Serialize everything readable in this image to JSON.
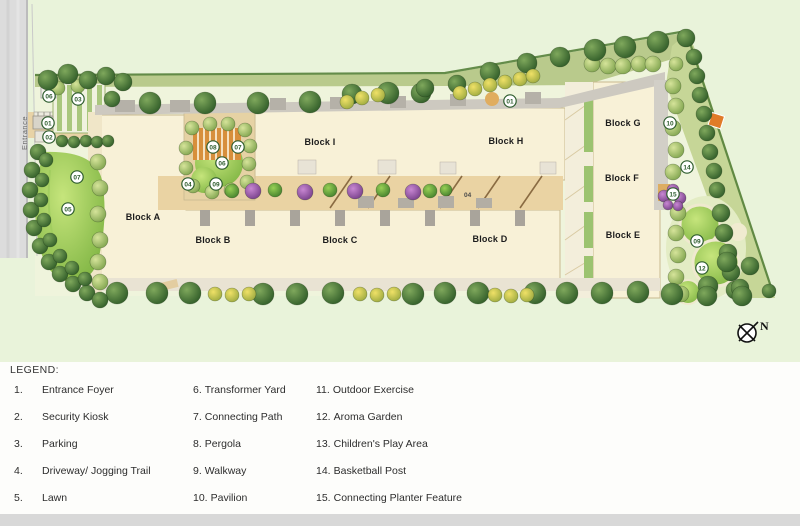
{
  "plan": {
    "entrance_label": "Entrance",
    "compass_label": "N",
    "driveway_code": "04",
    "colors": {
      "canvas_green": "#e9f3da",
      "site_interior": "#eff4dc",
      "building_cream": "#f8f1d7",
      "driveway_tan": "#ead3a3",
      "road_gray": "#dcdcdc",
      "tree_dark_green": "#2e5a27",
      "tree_light_green": "#7da24c",
      "flowering_purple": "#8a4a9a",
      "bush_yellow": "#e8d95f",
      "lawn_green": "#7ab13f",
      "marker_green": "#2e5d2e",
      "pergola_orange": "#d78f3c",
      "pavilion_orange": "#e07b28"
    },
    "blocks": [
      {
        "label": "Block A",
        "x": 143,
        "y": 220
      },
      {
        "label": "Block B",
        "x": 213,
        "y": 243
      },
      {
        "label": "Block C",
        "x": 340,
        "y": 243
      },
      {
        "label": "Block D",
        "x": 490,
        "y": 242
      },
      {
        "label": "Block E",
        "x": 623,
        "y": 238
      },
      {
        "label": "Block F",
        "x": 622,
        "y": 181
      },
      {
        "label": "Block G",
        "x": 623,
        "y": 126
      },
      {
        "label": "Block H",
        "x": 506,
        "y": 144
      },
      {
        "label": "Block I",
        "x": 320,
        "y": 145
      }
    ],
    "markers": [
      {
        "n": "06",
        "x": 49,
        "y": 96
      },
      {
        "n": "03",
        "x": 78,
        "y": 99
      },
      {
        "n": "01",
        "x": 48,
        "y": 123
      },
      {
        "n": "02",
        "x": 49,
        "y": 137
      },
      {
        "n": "07",
        "x": 77,
        "y": 177
      },
      {
        "n": "05",
        "x": 68,
        "y": 209
      },
      {
        "n": "08",
        "x": 213,
        "y": 147
      },
      {
        "n": "07",
        "x": 238,
        "y": 147
      },
      {
        "n": "06",
        "x": 222,
        "y": 163
      },
      {
        "n": "04",
        "x": 188,
        "y": 184
      },
      {
        "n": "09",
        "x": 216,
        "y": 184
      },
      {
        "n": "01",
        "x": 510,
        "y": 101
      },
      {
        "n": "10",
        "x": 670,
        "y": 123
      },
      {
        "n": "14",
        "x": 687,
        "y": 167
      },
      {
        "n": "15",
        "x": 673,
        "y": 194
      },
      {
        "n": "09",
        "x": 697,
        "y": 241
      },
      {
        "n": "12",
        "x": 702,
        "y": 268
      }
    ],
    "trees": {
      "dark": [
        [
          48,
          80,
          10
        ],
        [
          68,
          74,
          10
        ],
        [
          88,
          80,
          9
        ],
        [
          106,
          76,
          9
        ],
        [
          123,
          82,
          9
        ],
        [
          112,
          99,
          8
        ],
        [
          150,
          103,
          11
        ],
        [
          205,
          103,
          11
        ],
        [
          258,
          103,
          11
        ],
        [
          310,
          102,
          11
        ],
        [
          352,
          94,
          10
        ],
        [
          388,
          93,
          11
        ],
        [
          421,
          93,
          10
        ],
        [
          425,
          88,
          9
        ],
        [
          457,
          84,
          9
        ],
        [
          490,
          72,
          10
        ],
        [
          527,
          63,
          10
        ],
        [
          560,
          57,
          10
        ],
        [
          595,
          50,
          11
        ],
        [
          625,
          47,
          11
        ],
        [
          658,
          42,
          11
        ],
        [
          686,
          38,
          9
        ],
        [
          694,
          57,
          8
        ],
        [
          697,
          76,
          8
        ],
        [
          700,
          95,
          8
        ],
        [
          704,
          114,
          8
        ],
        [
          707,
          133,
          8
        ],
        [
          710,
          152,
          8
        ],
        [
          714,
          171,
          8
        ],
        [
          717,
          190,
          8
        ],
        [
          721,
          213,
          9
        ],
        [
          724,
          233,
          9
        ],
        [
          728,
          253,
          9
        ],
        [
          731,
          272,
          9
        ],
        [
          735,
          290,
          9
        ],
        [
          727,
          262,
          10
        ],
        [
          750,
          266,
          9
        ],
        [
          708,
          286,
          10
        ],
        [
          740,
          288,
          9
        ],
        [
          117,
          293,
          11
        ],
        [
          157,
          293,
          11
        ],
        [
          190,
          293,
          11
        ],
        [
          263,
          294,
          11
        ],
        [
          297,
          294,
          11
        ],
        [
          333,
          293,
          11
        ],
        [
          413,
          294,
          11
        ],
        [
          445,
          293,
          11
        ],
        [
          478,
          293,
          11
        ],
        [
          535,
          293,
          11
        ],
        [
          567,
          293,
          11
        ],
        [
          602,
          293,
          11
        ],
        [
          638,
          292,
          11
        ],
        [
          672,
          294,
          11
        ],
        [
          707,
          296,
          10
        ],
        [
          742,
          296,
          10
        ],
        [
          769,
          291,
          7
        ],
        [
          38,
          152,
          8
        ],
        [
          32,
          170,
          8
        ],
        [
          30,
          190,
          8
        ],
        [
          31,
          210,
          8
        ],
        [
          34,
          228,
          8
        ],
        [
          40,
          246,
          8
        ],
        [
          49,
          262,
          8
        ],
        [
          60,
          274,
          8
        ],
        [
          73,
          284,
          8
        ],
        [
          87,
          293,
          8
        ],
        [
          100,
          300,
          8
        ],
        [
          46,
          160,
          7
        ],
        [
          42,
          180,
          7
        ],
        [
          41,
          200,
          7
        ],
        [
          44,
          220,
          7
        ],
        [
          50,
          240,
          7
        ],
        [
          60,
          256,
          7
        ],
        [
          72,
          268,
          7
        ],
        [
          85,
          279,
          7
        ]
      ],
      "light": [
        [
          58,
          88,
          7
        ],
        [
          78,
          86,
          7
        ],
        [
          592,
          64,
          8
        ],
        [
          608,
          66,
          8
        ],
        [
          623,
          66,
          8
        ],
        [
          639,
          64,
          8
        ],
        [
          653,
          64,
          8
        ],
        [
          676,
          64,
          7
        ],
        [
          673,
          86,
          8
        ],
        [
          676,
          106,
          8
        ],
        [
          673,
          128,
          8
        ],
        [
          676,
          150,
          8
        ],
        [
          673,
          172,
          8
        ],
        [
          678,
          213,
          8
        ],
        [
          676,
          233,
          8
        ],
        [
          678,
          255,
          8
        ],
        [
          676,
          277,
          8
        ],
        [
          681,
          294,
          8
        ],
        [
          98,
          162,
          8
        ],
        [
          100,
          188,
          8
        ],
        [
          98,
          214,
          8
        ],
        [
          100,
          240,
          8
        ],
        [
          98,
          262,
          8
        ],
        [
          100,
          282,
          8
        ],
        [
          192,
          128,
          7
        ],
        [
          210,
          124,
          7
        ],
        [
          228,
          124,
          7
        ],
        [
          245,
          130,
          7
        ],
        [
          250,
          146,
          7
        ],
        [
          249,
          164,
          7
        ],
        [
          247,
          182,
          7
        ],
        [
          231,
          190,
          7
        ],
        [
          212,
          192,
          7
        ],
        [
          193,
          186,
          7
        ],
        [
          186,
          168,
          7
        ],
        [
          186,
          148,
          7
        ]
      ],
      "yellow": [
        [
          347,
          102,
          7
        ],
        [
          362,
          98,
          7
        ],
        [
          378,
          95,
          7
        ],
        [
          460,
          93,
          7
        ],
        [
          475,
          89,
          7
        ],
        [
          490,
          85,
          7
        ],
        [
          505,
          82,
          7
        ],
        [
          520,
          79,
          7
        ],
        [
          533,
          76,
          7
        ],
        [
          215,
          294,
          7
        ],
        [
          232,
          295,
          7
        ],
        [
          249,
          294,
          7
        ],
        [
          360,
          294,
          7
        ],
        [
          377,
          295,
          7
        ],
        [
          394,
          294,
          7
        ],
        [
          495,
          295,
          7
        ],
        [
          511,
          296,
          7
        ],
        [
          527,
          295,
          7
        ]
      ],
      "shrub": [
        [
          232,
          191,
          7
        ],
        [
          275,
          190,
          7
        ],
        [
          330,
          190,
          7
        ],
        [
          383,
          190,
          7
        ],
        [
          430,
          191,
          7
        ],
        [
          446,
          190,
          6
        ]
      ],
      "hedge": [
        [
          62,
          141,
          6
        ],
        [
          74,
          142,
          6
        ],
        [
          86,
          141,
          6
        ],
        [
          97,
          142,
          6
        ],
        [
          108,
          141,
          6
        ]
      ],
      "purple": [
        [
          253,
          191,
          8
        ],
        [
          305,
          192,
          8
        ],
        [
          355,
          191,
          8
        ],
        [
          413,
          192,
          8
        ],
        [
          664,
          196,
          6
        ],
        [
          673,
          190,
          6
        ],
        [
          680,
          198,
          6
        ],
        [
          668,
          205,
          5
        ],
        [
          678,
          206,
          5
        ]
      ]
    }
  },
  "legend": {
    "title": "LEGEND:",
    "columns": [
      {
        "items": [
          {
            "num": "1.",
            "label": "Entrance Foyer"
          },
          {
            "num": "2.",
            "label": "Security Kiosk"
          },
          {
            "num": "3.",
            "label": "Parking"
          },
          {
            "num": "4.",
            "label": "Driveway/ Jogging Trail"
          },
          {
            "num": "5.",
            "label": "Lawn"
          }
        ]
      },
      {
        "items": [
          {
            "num": "6.",
            "label": "Transformer Yard"
          },
          {
            "num": "7.",
            "label": "Connecting Path"
          },
          {
            "num": "8.",
            "label": "Pergola"
          },
          {
            "num": "9.",
            "label": "Walkway"
          },
          {
            "num": "10.",
            "label": "Pavilion"
          }
        ]
      },
      {
        "items": [
          {
            "num": "11.",
            "label": "Outdoor Exercise"
          },
          {
            "num": "12.",
            "label": "Aroma Garden"
          },
          {
            "num": "13.",
            "label": "Children's Play Area"
          },
          {
            "num": "14.",
            "label": "Basketball Post"
          },
          {
            "num": "15.",
            "label": "Connecting Planter Feature"
          }
        ]
      }
    ]
  }
}
